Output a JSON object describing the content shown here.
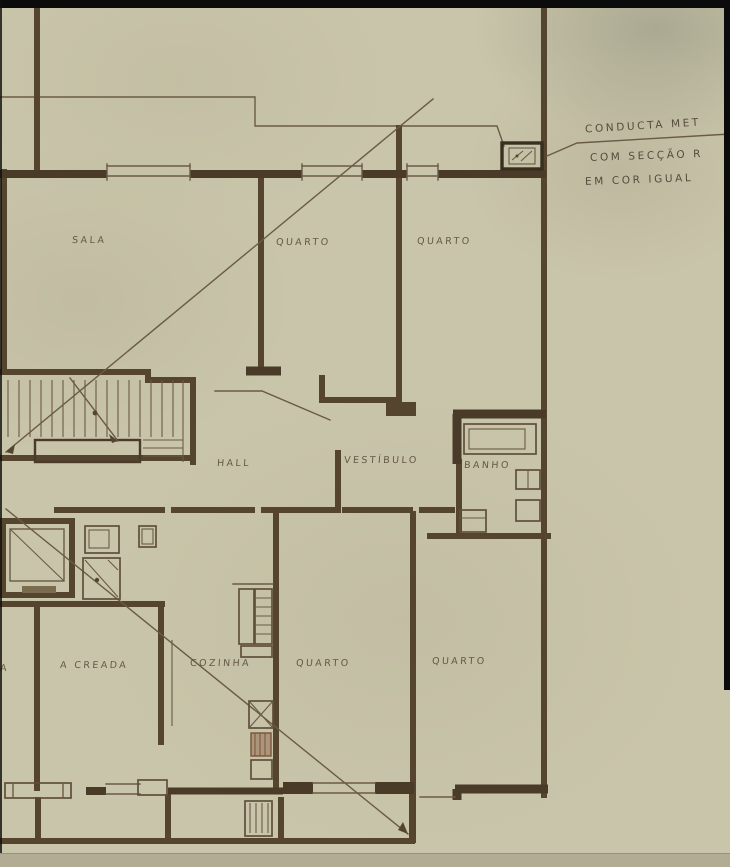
{
  "drawing": {
    "kind_label": "floor-plan",
    "rooms": [
      {
        "id": "sala",
        "label": "SALA",
        "x": 72,
        "y": 235
      },
      {
        "id": "quarto-1",
        "label": "QUARTO",
        "x": 276,
        "y": 237
      },
      {
        "id": "quarto-2",
        "label": "QUARTO",
        "x": 417,
        "y": 236
      },
      {
        "id": "hall",
        "label": "HALL",
        "x": 217,
        "y": 458
      },
      {
        "id": "vestibulo",
        "label": "VESTÍBULO",
        "x": 344,
        "y": 455
      },
      {
        "id": "banho",
        "label": "BANHO",
        "x": 464,
        "y": 460
      },
      {
        "id": "creada",
        "label": "A CREADA",
        "x": 60,
        "y": 660
      },
      {
        "id": "cozinha",
        "label": "COZINHA",
        "x": 190,
        "y": 658
      },
      {
        "id": "quarto-3",
        "label": "QUARTO",
        "x": 296,
        "y": 658
      },
      {
        "id": "quarto-4",
        "label": "QUARTO",
        "x": 432,
        "y": 656
      },
      {
        "id": "label-fragment",
        "label": "A",
        "x": 0,
        "y": 663
      }
    ],
    "annotation": {
      "lines": [
        "CONDUCTA MET",
        "COM SECÇÃO R",
        "EM COR IGUAL"
      ]
    }
  },
  "colors": {
    "paper": "#c9c5aa",
    "ink": "#55452f",
    "ink-dark": "#4a3b28",
    "hatch": "#8a5f45",
    "black": "#0b0b0b"
  }
}
